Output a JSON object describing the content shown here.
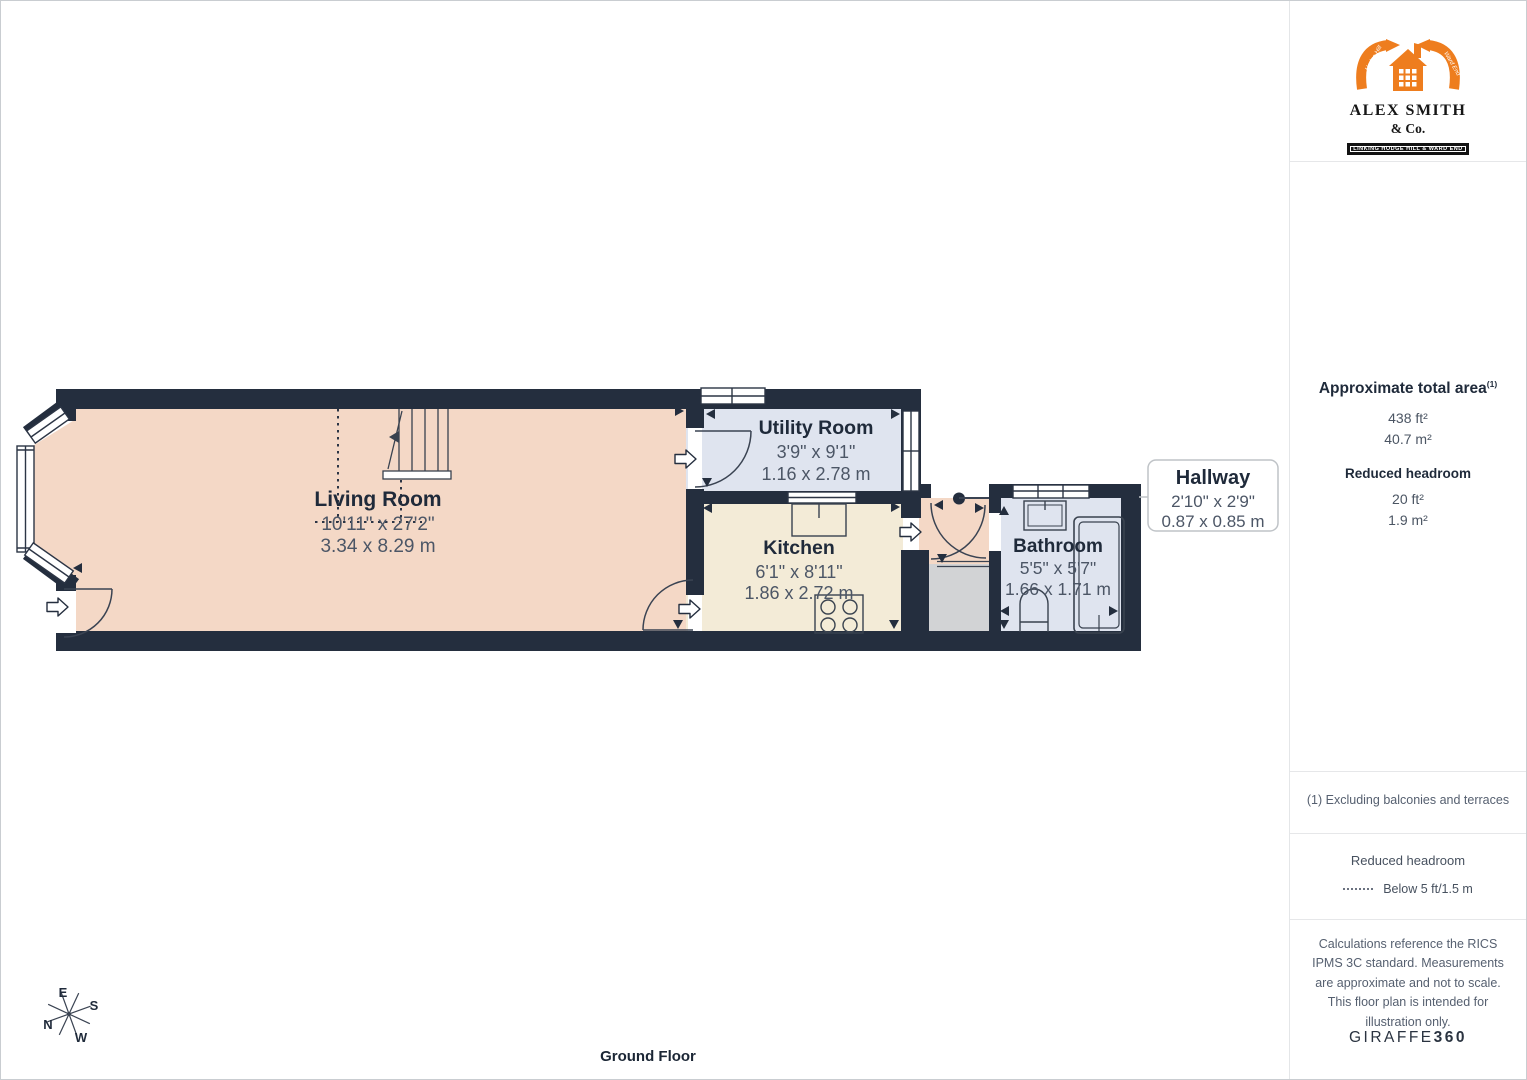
{
  "branding": {
    "agency_name": "ALEX SMITH",
    "agency_suffix": "& Co.",
    "agency_tagline": "LINKING HODGE HILL & WARD END",
    "arrow_script_left": "Hodge Hill",
    "arrow_script_right": "Ward End",
    "provider": "GIRAFFE",
    "provider_bold": "360"
  },
  "sidebar": {
    "area_title": "Approximate total area",
    "area_title_sup": "(1)",
    "area_sqft": "438 ft²",
    "area_sqm": "40.7 m²",
    "reduced_title": "Reduced headroom",
    "reduced_sqft": "20 ft²",
    "reduced_sqm": "1.9 m²",
    "footnote": "(1) Excluding balconies and terraces",
    "legend_title": "Reduced headroom",
    "legend_item": "Below 5 ft/1.5 m",
    "disclaimer": "Calculations reference the RICS IPMS 3C standard. Measurements are approximate and not to scale. This floor plan is intended for illustration only."
  },
  "plan": {
    "floor_label": "Ground Floor",
    "rooms": {
      "living": {
        "name": "Living Room",
        "imperial": "10'11\" x 27'2\"",
        "metric": "3.34 x 8.29 m"
      },
      "utility": {
        "name": "Utility Room",
        "imperial": "3'9\" x 9'1\"",
        "metric": "1.16 x 2.78 m"
      },
      "kitchen": {
        "name": "Kitchen",
        "imperial": "6'1\" x 8'11\"",
        "metric": "1.86 x 2.72 m"
      },
      "hallway": {
        "name": "Hallway",
        "imperial": "2'10\" x 2'9\"",
        "metric": "0.87 x 0.85 m"
      },
      "bathroom": {
        "name": "Bathroom",
        "imperial": "5'5\" x 5'7\"",
        "metric": "1.66 x 1.71 m"
      }
    },
    "compass": {
      "north": "N",
      "east": "E",
      "south": "S",
      "west": "W"
    }
  },
  "colors": {
    "wall": "#242e3e",
    "room_warm": "#f4d8c6",
    "room_cool": "#dfe4ef",
    "room_cream": "#f3ebd7",
    "storage_grey": "#d2d3d5",
    "accent_orange": "#ee7d1e",
    "text_dark": "#1f2a3a",
    "text_muted": "#4c5666"
  }
}
